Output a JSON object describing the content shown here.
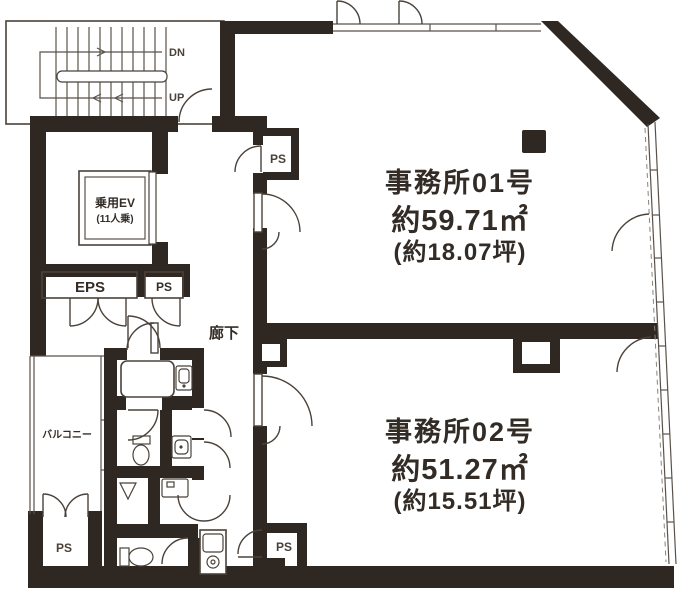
{
  "plan": {
    "stairwell": {
      "down_label": "DN",
      "up_label": "UP"
    },
    "elevator": {
      "name": "乗用EV",
      "capacity": "(11人乗)"
    },
    "shafts": {
      "eps": "EPS",
      "ps_mid_left": "PS",
      "ps_top_center": "PS",
      "ps_bottom_left": "PS",
      "ps_bottom_center": "PS"
    },
    "corridor": {
      "label": "廊下"
    },
    "balcony": {
      "label": "バルコニー"
    },
    "office1": {
      "name": "事務所01号",
      "area_m2": "約59.71㎡",
      "area_tsubo": "(約18.07坪)"
    },
    "office2": {
      "name": "事務所02号",
      "area_m2": "約51.27㎡",
      "area_tsubo": "(約15.51坪)"
    },
    "colors": {
      "wall": "#2e2722",
      "line": "#4a423a",
      "text": "#332c26",
      "background": "#ffffff"
    }
  }
}
